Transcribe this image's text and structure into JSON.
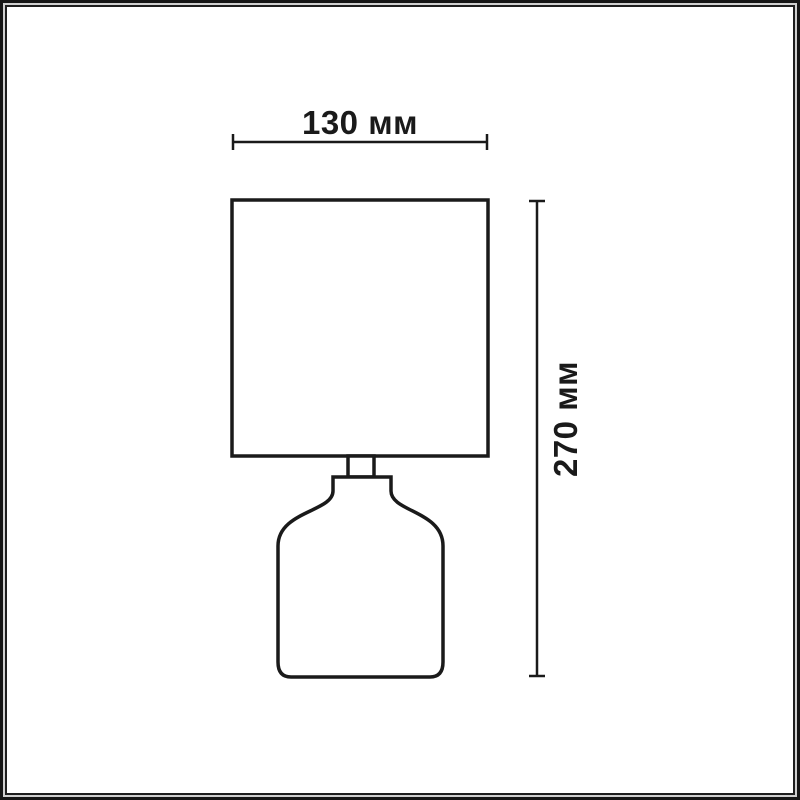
{
  "drawing": {
    "type": "product-dimension-diagram",
    "subject": "table-lamp",
    "dimensions": {
      "width_label": "130 мм",
      "height_label": "270 мм"
    }
  },
  "colors": {
    "background": "#ffffff",
    "line": "#1a1a1a",
    "frame_outer": "#151515",
    "frame_mid": "#cfcfcf",
    "frame_inner": "#1e1e1e"
  }
}
